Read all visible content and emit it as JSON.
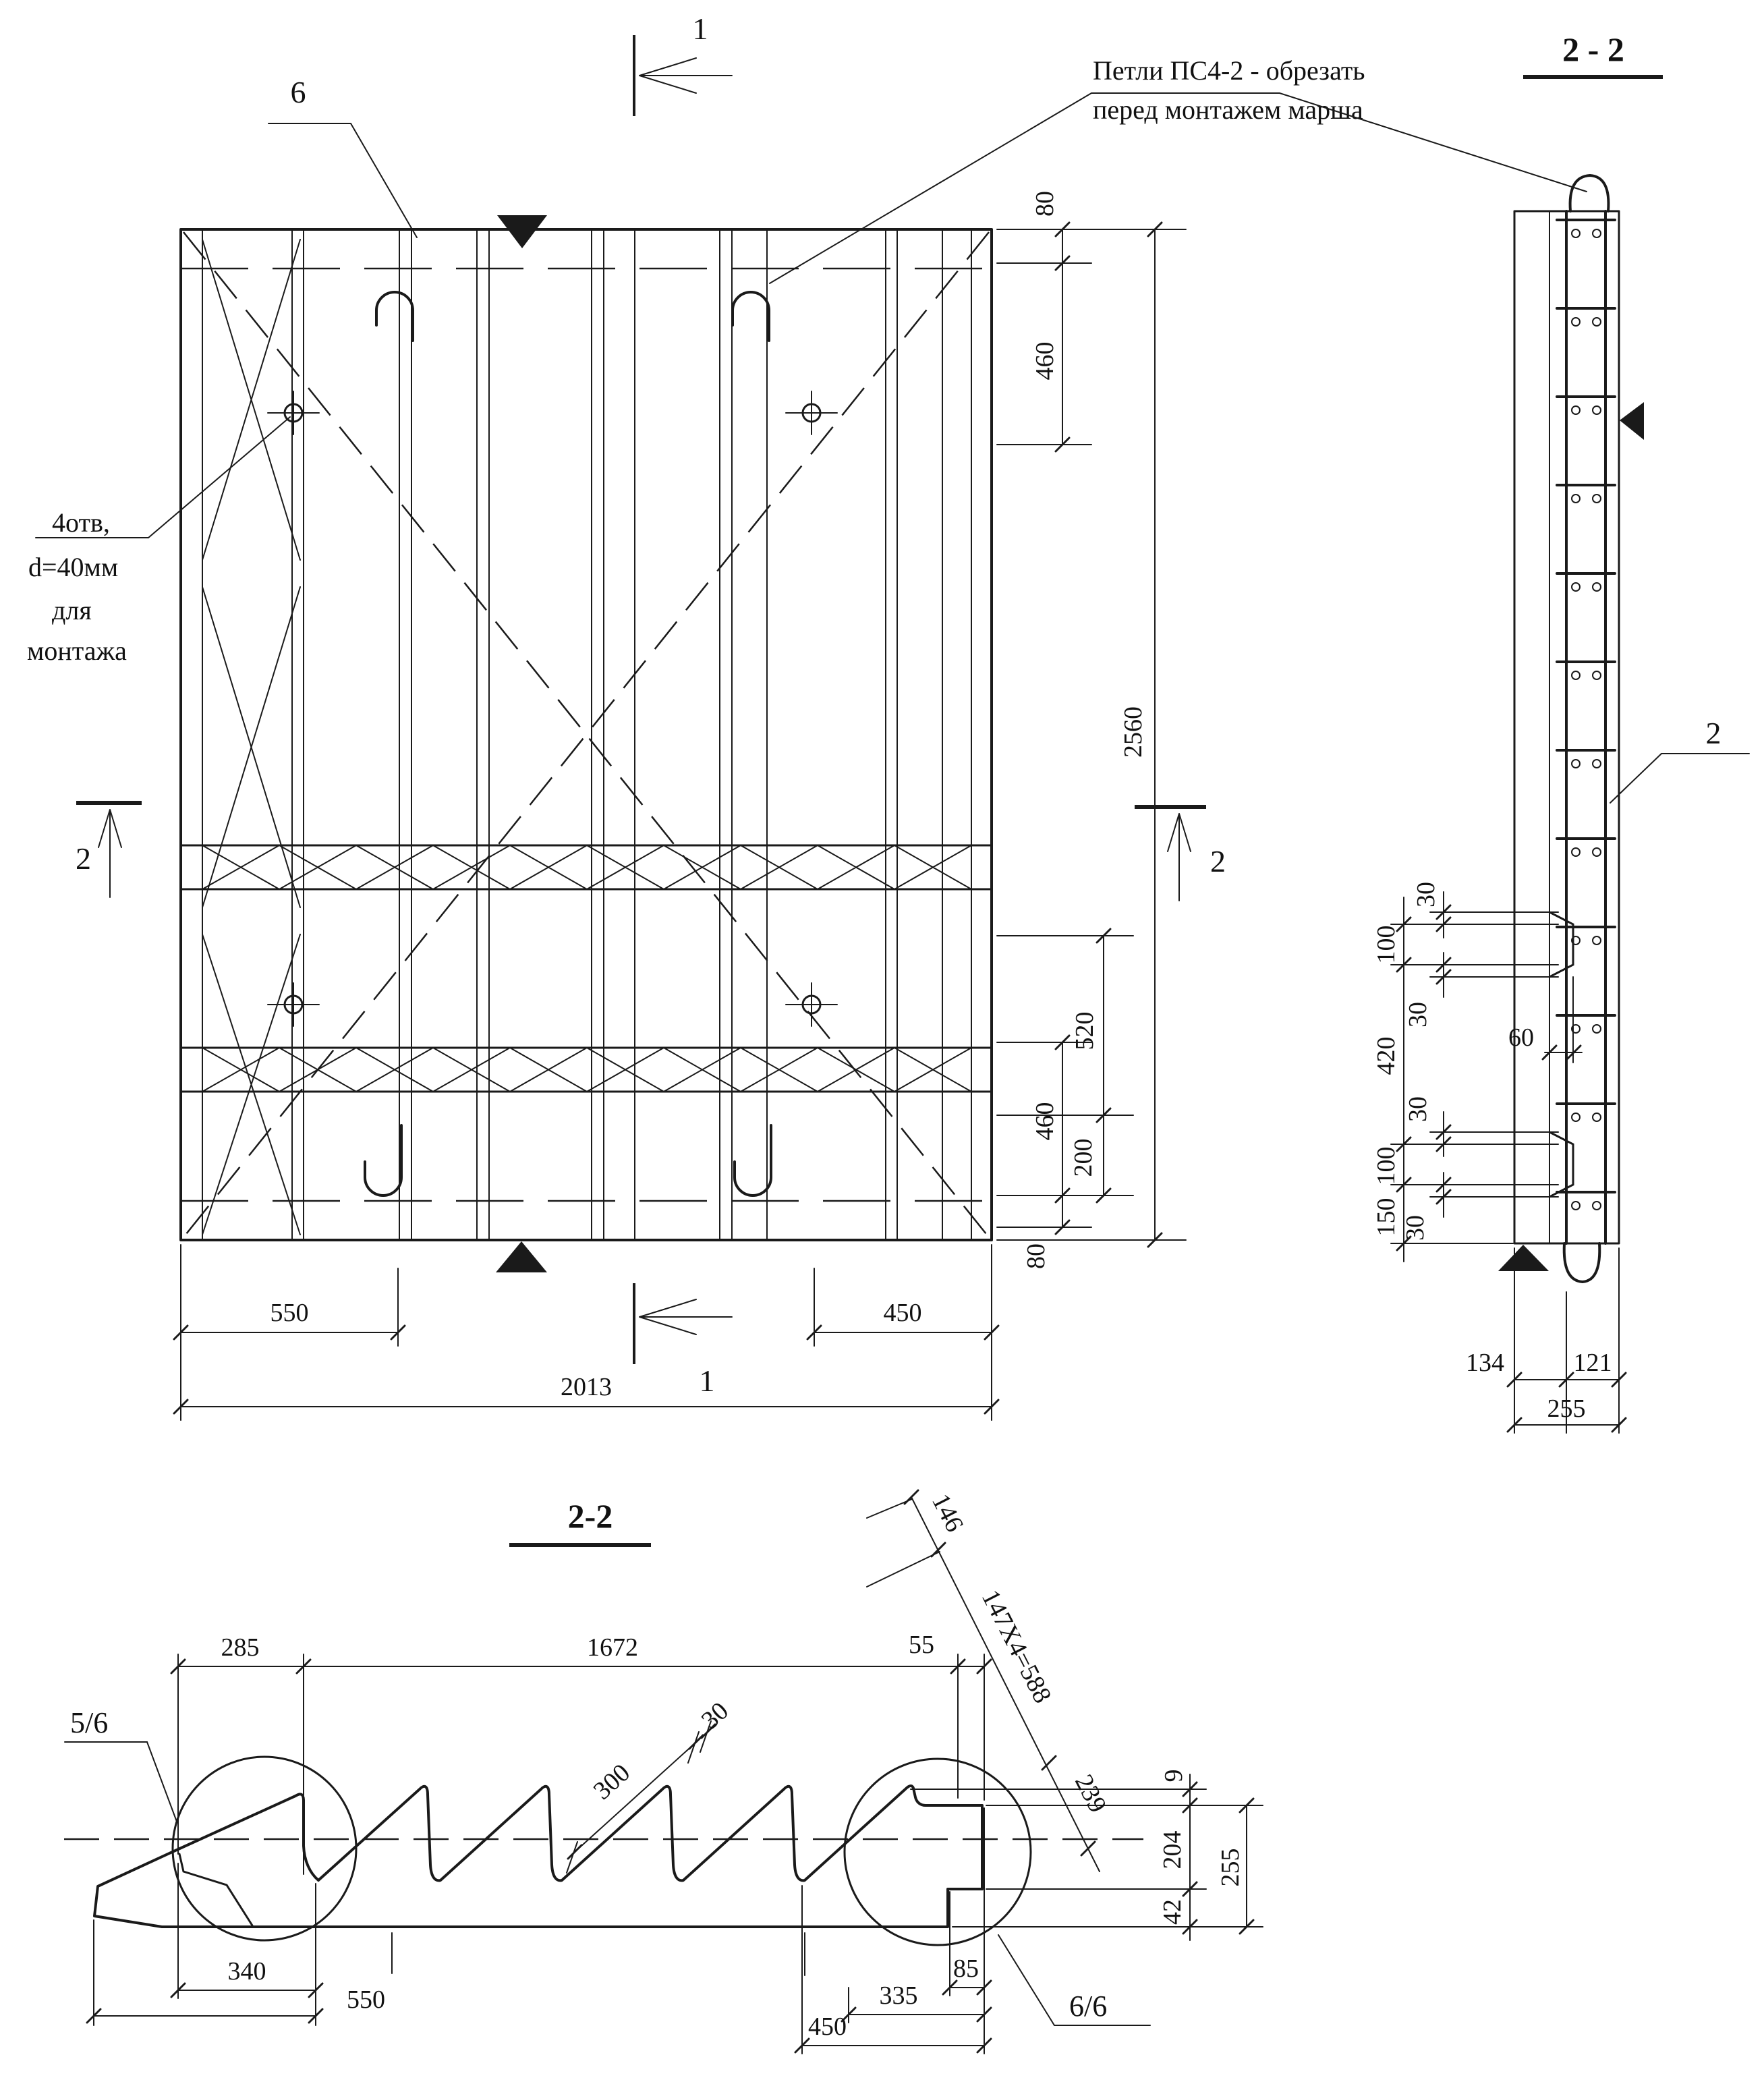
{
  "notes": {
    "loops": {
      "line1": "Петли ПС4-2 - обрезать",
      "line2": "перед монтажем марша"
    },
    "holes": {
      "line1": "4отв,",
      "line2": "d=40мм",
      "line3": "для",
      "line4": "монтажа"
    }
  },
  "titles": {
    "side_section": "2 - 2",
    "long_section": "2-2"
  },
  "labels": {
    "rebar": "6",
    "mesh": "2",
    "section1_top": "1",
    "section1_bottom": "1",
    "section2_left": "2",
    "section2_right": "2",
    "detail_left": "5/6",
    "detail_right": "6/6"
  },
  "dims": {
    "plan": {
      "top80": "80",
      "top460": "460",
      "height": "2560",
      "mid520": "520",
      "mid460": "460",
      "mid200": "200",
      "bot80": "80",
      "bottom_left": "550",
      "bottom_right": "450",
      "width": "2013"
    },
    "side": {
      "c100a": "100",
      "c420": "420",
      "c100b": "100",
      "c150": "150",
      "n30a": "30",
      "n30b": "30",
      "n30c": "30",
      "n30d": "30",
      "n60": "60",
      "w134": "134",
      "w121": "121",
      "w255": "255"
    },
    "section": {
      "s285": "285",
      "s1672": "1672",
      "s55": "55",
      "tread": "300",
      "nose": "30",
      "inc146": "146",
      "inc147": "147X4=588",
      "inc239": "239",
      "v9": "9",
      "v204": "204",
      "v42": "42",
      "v255": "255",
      "b340": "340",
      "b550": "550",
      "b450": "450",
      "b335": "335",
      "b85": "85"
    }
  }
}
